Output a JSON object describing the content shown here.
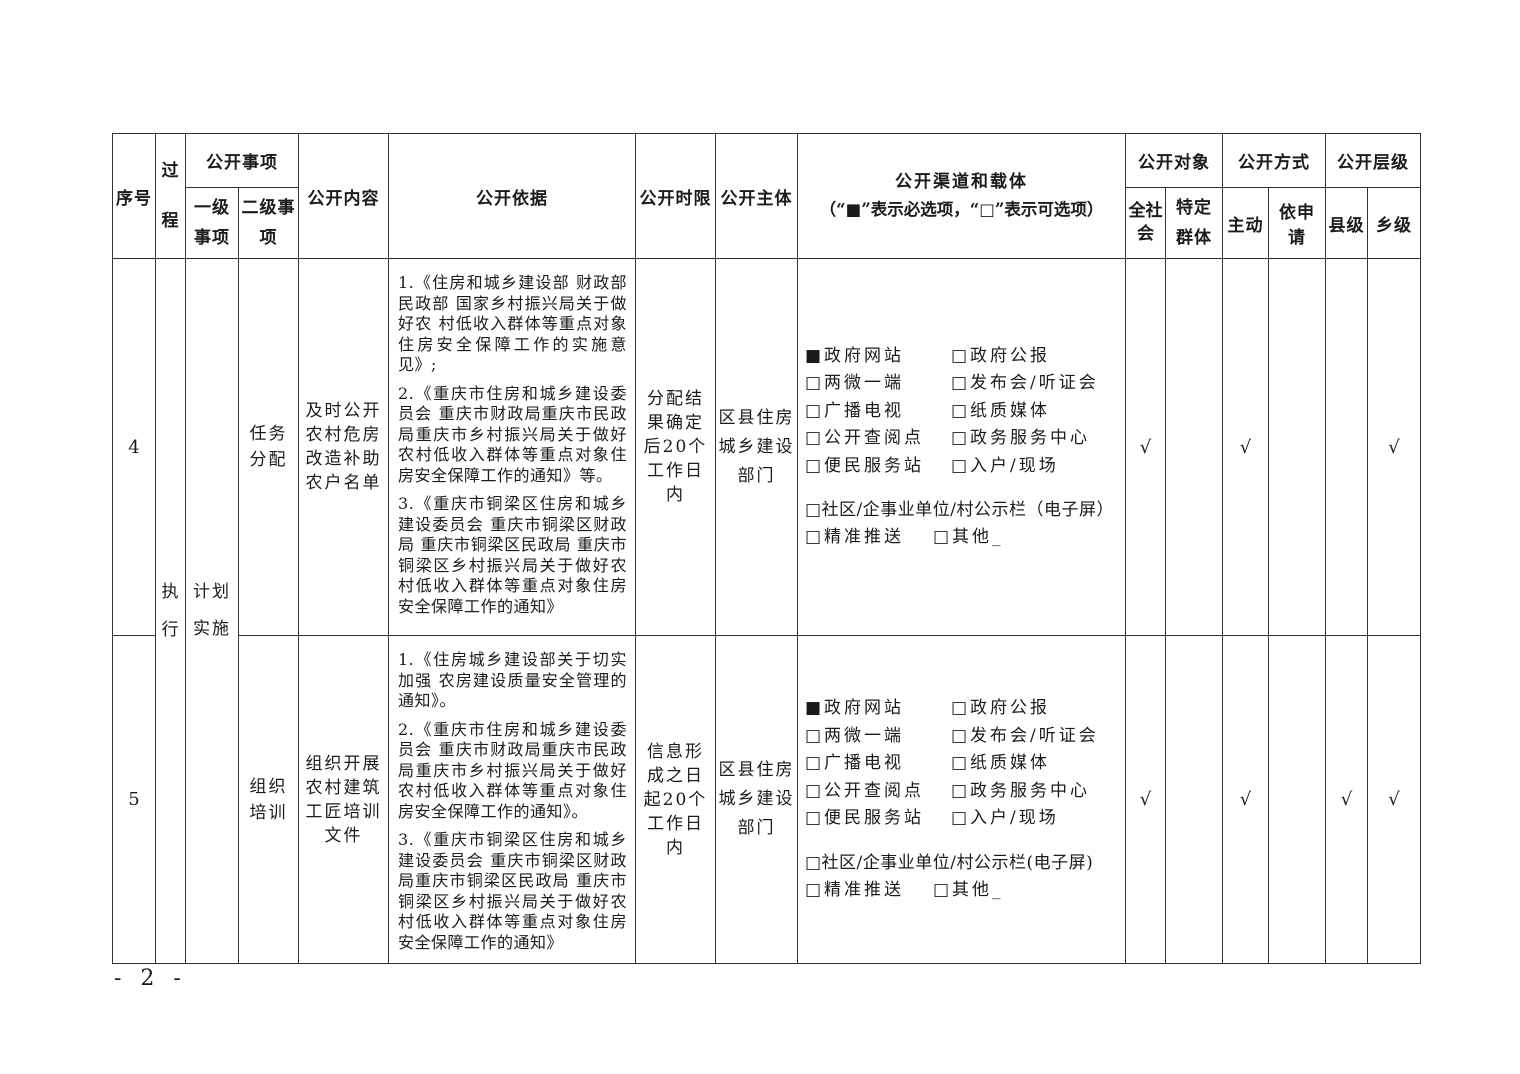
{
  "footer": {
    "page_number": "- 2 -"
  },
  "table": {
    "header": {
      "xuhao": "序号",
      "guocheng": "过程",
      "shixiang": "公开事项",
      "yiji": "一级事项",
      "erji": "二级事项",
      "neirong": "公开内容",
      "yiju": "公开依据",
      "shixian": "公开时限",
      "zhuti": "公开主体",
      "qudao_line1": "公开渠道和载体",
      "qudao_line2": "（“■”表示必选项，“□”表示可选项）",
      "duixiang": "公开对象",
      "fangshi": "公开方式",
      "cengji": "公开层级",
      "quanshehui": "全社会",
      "teding": "特定群体",
      "zhudong": "主动",
      "yishenqing": "依申请",
      "xianji": "县级",
      "xiangji": "乡级"
    },
    "rows": [
      {
        "id": "4",
        "process": "执行",
        "level1": "计划实施",
        "level2": "任务分配",
        "content": "及时公开农村危房改造补助农户名单",
        "basis": [
          "1.《住房和城乡建设部 财政部 民政部 国家乡村振兴局关于做好农 村低收入群体等重点对象住房安全保障工作的实施意见》;",
          "2.《重庆市住房和城乡建设委员会 重庆市财政局重庆市民政局重庆市乡村振兴局关于做好农村低收入群体等重点对象住房安全保障工作的通知》等。",
          "3.《重庆市铜梁区住房和城乡建设委员会  重庆市铜梁区财政局 重庆市铜梁区民政局 重庆市铜梁区乡村振兴局关于做好农村低收入群体等重点对象住房安全保障工作的通知》"
        ],
        "time_limit": "分配结果确定后20个工作日内",
        "subject": "区县住房城乡建设部门",
        "channels": {
          "left": [
            "■政府网站",
            "□两微一端",
            "□广播电视",
            "□公开查阅点",
            "□便民服务站"
          ],
          "right": [
            "□政府公报",
            "□发布会/听证会",
            "□纸质媒体",
            "□政务服务中心",
            "□入户/现场"
          ],
          "full": "□社区/企事业单位/村公示栏（电子屏）",
          "extra1": "□精准推送",
          "extra2": "□其他_"
        },
        "marks": [
          "√",
          "",
          "√",
          "",
          "",
          "√"
        ]
      },
      {
        "id": "5",
        "level2": "组织培训",
        "content": "组织开展农村建筑工匠培训文件",
        "basis": [
          "1.《住房城乡建设部关于切实加强 农房建设质量安全管理的通知》。",
          "2.《重庆市住房和城乡建设委员会 重庆市财政局重庆市民政局重庆市乡村振兴局关于做好农村低收入群体等重点对象住房安全保障工作的通知》。",
          "3.《重庆市铜梁区住房和城乡建设委员会 重庆市铜梁区财政局重庆市铜梁区民政局 重庆市铜梁区乡村振兴局关于做好农村低收入群体等重点对象住房安全保障工作的通知》"
        ],
        "time_limit": "信息形成之日起20个工作日内",
        "subject": "区县住房城乡建设部门",
        "channels": {
          "left": [
            "■政府网站",
            "□两微一端",
            "□广播电视",
            "□公开查阅点",
            "□便民服务站"
          ],
          "right": [
            "□政府公报",
            "□发布会/听证会",
            "□纸质媒体",
            "□政务服务中心",
            "□入户/现场"
          ],
          "full": "□社区/企事业单位/村公示栏(电子屏)",
          "extra1": "□精准推送",
          "extra2": "□其他_"
        },
        "marks": [
          "√",
          "",
          "√",
          "",
          "√",
          "√"
        ]
      }
    ]
  }
}
